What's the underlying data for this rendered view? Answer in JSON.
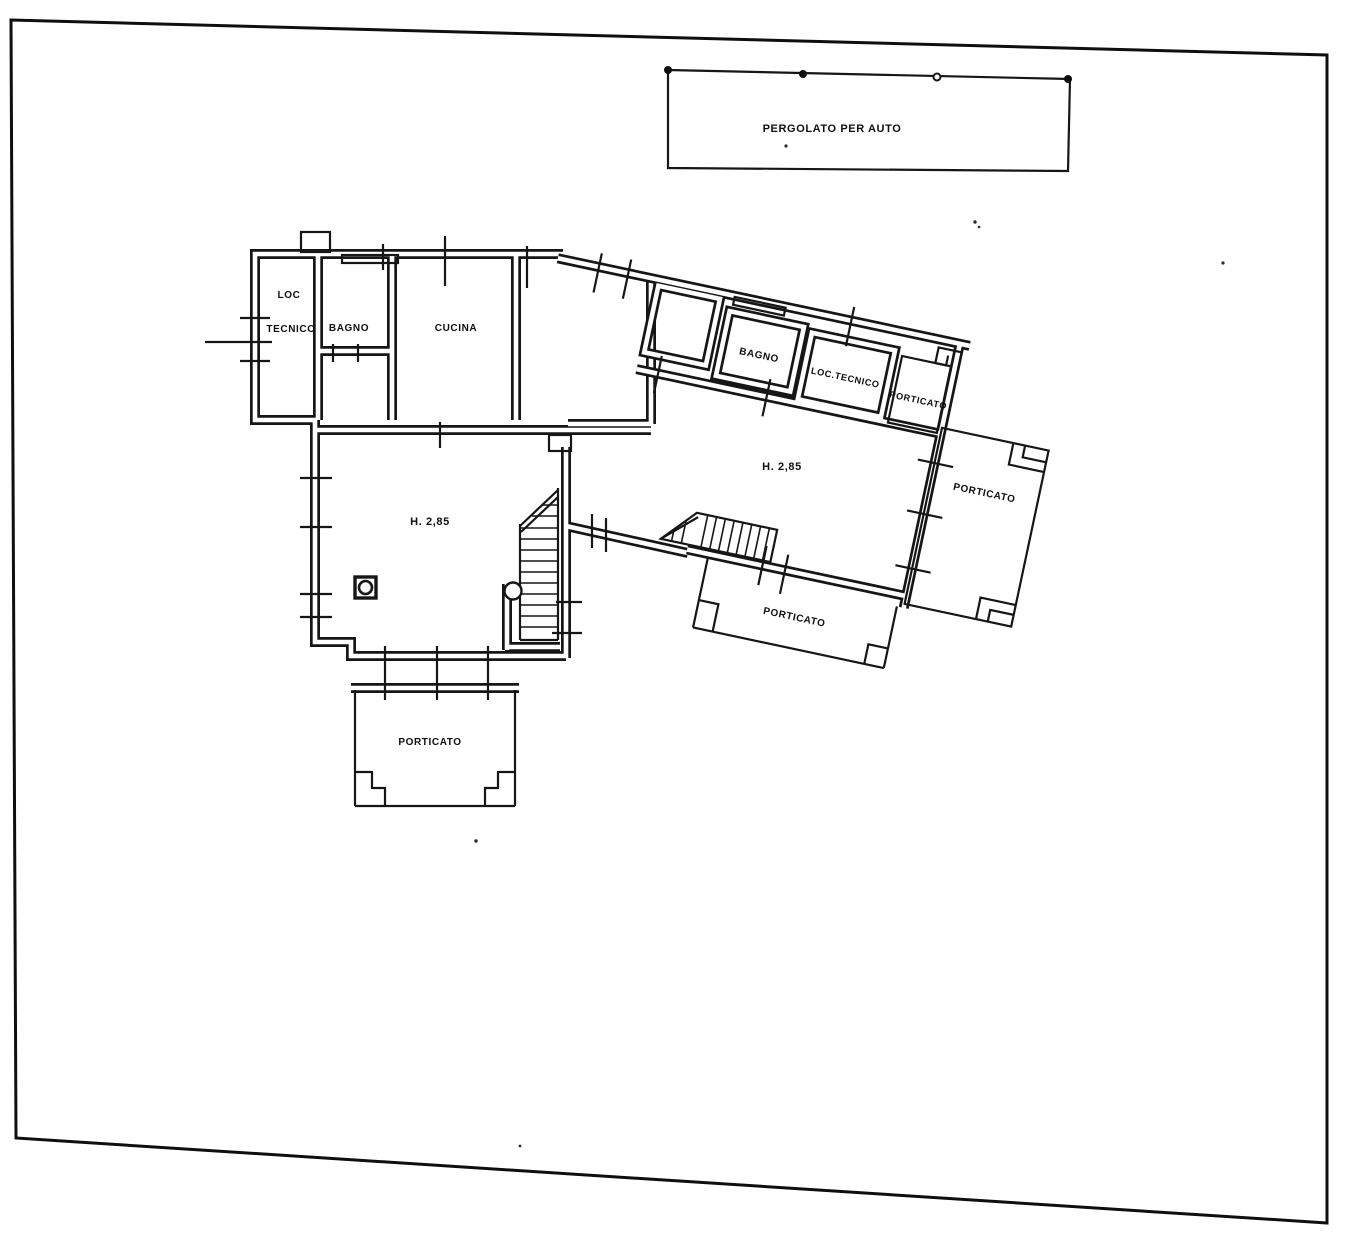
{
  "palette": {
    "ink": "#161616",
    "paper": "#ffffff"
  },
  "plan": {
    "pergolato": {
      "label": "PERGOLATO PER AUTO"
    },
    "left_wing": {
      "loc_tecnico_line1": "LOC",
      "loc_tecnico_line2": "TECNICO",
      "bagno": "BAGNO",
      "cucina": "CUCINA"
    },
    "right_wing": {
      "bagno": "BAGNO",
      "loc_tecnico": "LOC.TECNICO",
      "porticato_end": "PORTICATO"
    },
    "rooms": {
      "living_left_height": "H. 2,85",
      "living_right_height": "H. 2,85"
    },
    "porches": {
      "bottom_left": "PORTICATO",
      "bottom_center": "PORTICATO",
      "right": "PORTICATO"
    }
  }
}
